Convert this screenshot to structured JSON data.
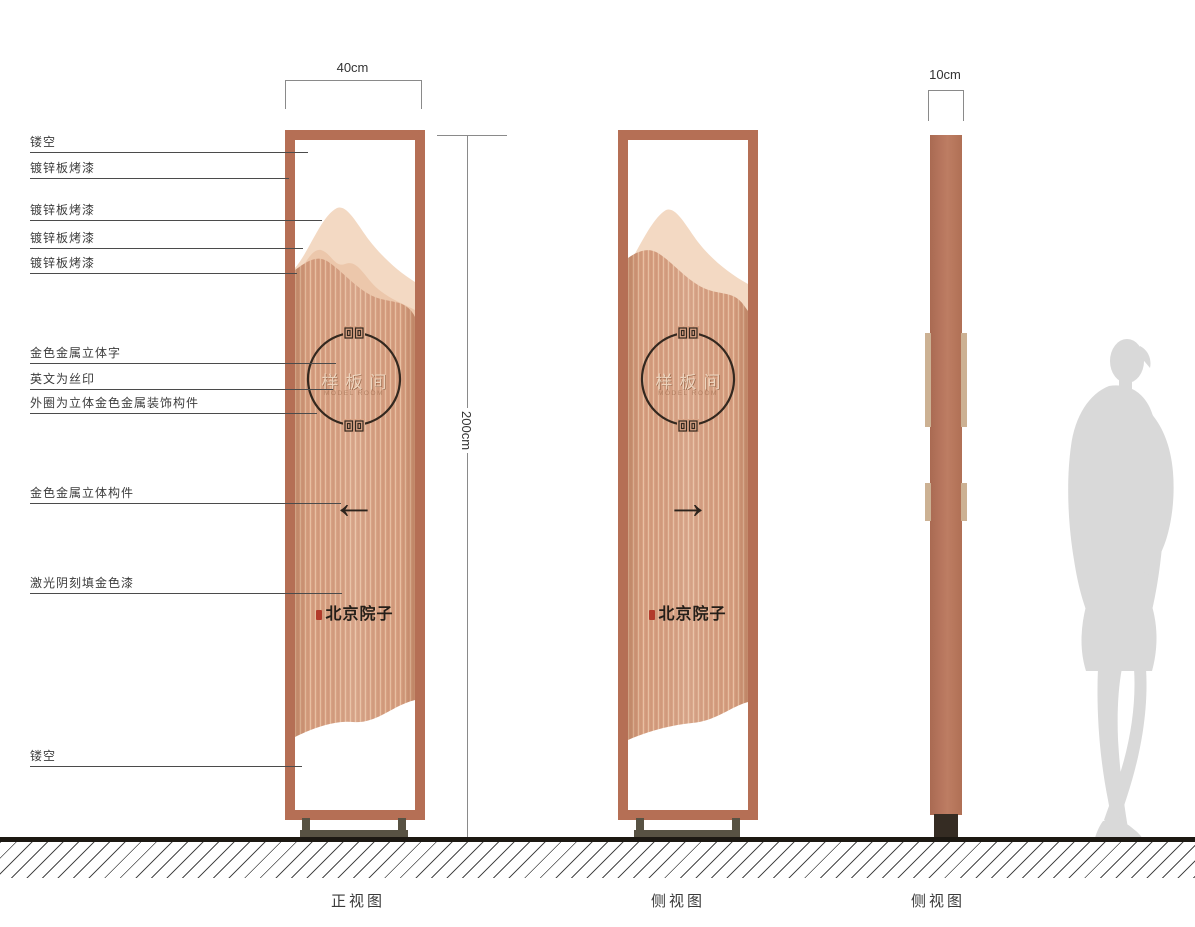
{
  "callouts": [
    {
      "label": "镂空"
    },
    {
      "label": "镀锌板烤漆"
    },
    {
      "label": "镀锌板烤漆"
    },
    {
      "label": "镀锌板烤漆"
    },
    {
      "label": "镀锌板烤漆"
    },
    {
      "label": "金色金属立体字"
    },
    {
      "label": "英文为丝印"
    },
    {
      "label": "外圈为立体金色金属装饰构件"
    },
    {
      "label": "金色金属立体构件"
    },
    {
      "label": "激光阴刻填金色漆"
    },
    {
      "label": "镂空"
    }
  ],
  "dimensions": {
    "front_width": "40cm",
    "total_height": "200cm",
    "side_depth": "10cm"
  },
  "plate": {
    "name_cn": "样板间",
    "name_en": "MODEL ROOM",
    "brand": "北京院子",
    "arrow_left": "←",
    "arrow_right": "→"
  },
  "captions": {
    "front_view": "正视图",
    "side_view_1": "侧视图",
    "side_view_2": "侧视图"
  },
  "colors": {
    "frame_copper": "#b56f55",
    "panel_copper": "#d8a183",
    "mountain_light": "#f3d9c3",
    "mountain_mid": "#ecc7ab",
    "ink_dark": "#2d241d",
    "seal_red": "#b23b2b",
    "base_olive": "#585243",
    "column_base_dark": "#352c23",
    "accent_strip": "#ccb193",
    "silhouette_gray": "#d9d9d9",
    "ground_dark": "#1c1812"
  }
}
